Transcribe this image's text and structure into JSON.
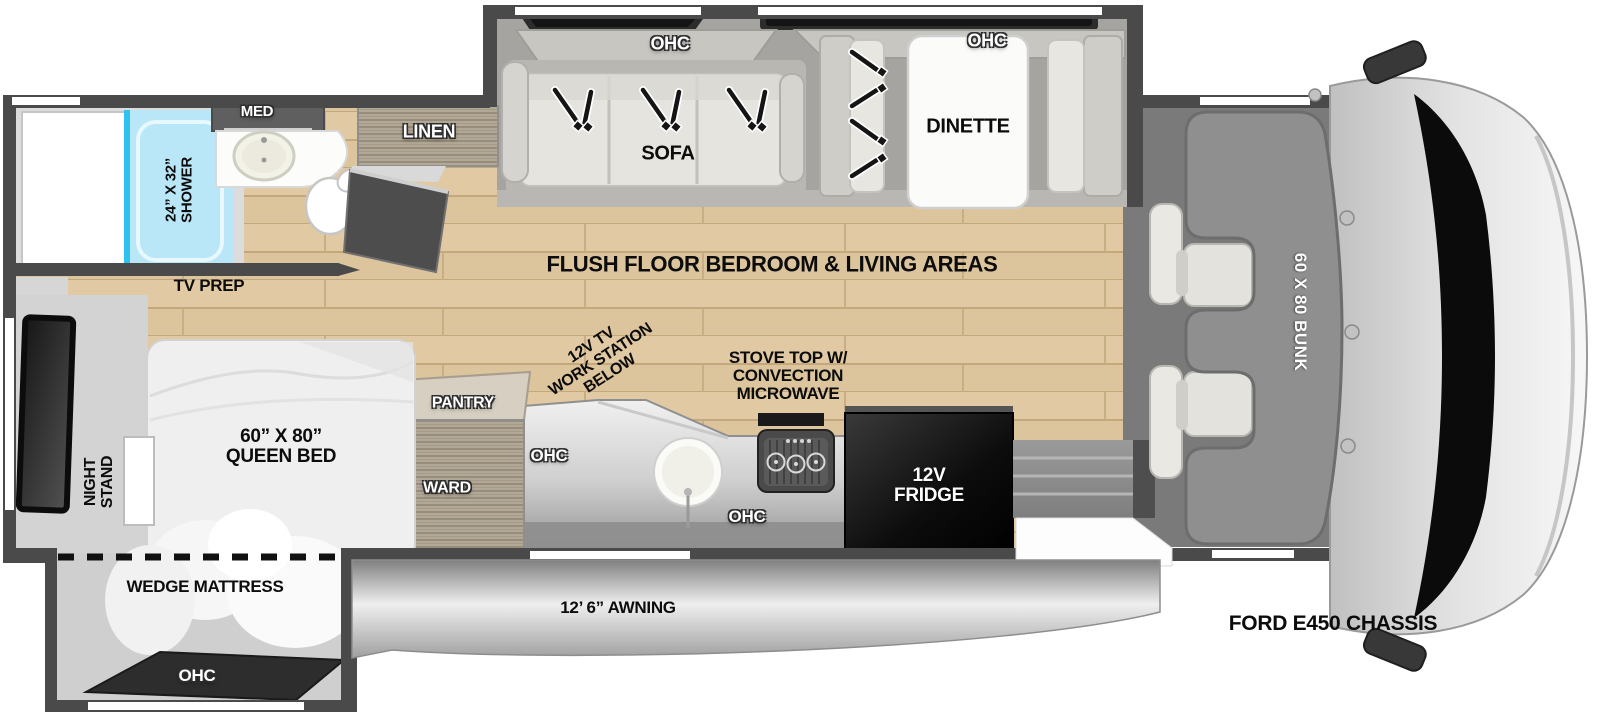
{
  "floorplan": {
    "living": {
      "ohc_sofa": "OHC",
      "sofa": "SOFA",
      "ohc_dinette": "OHC",
      "dinette": "DINETTE",
      "flush_floor": "FLUSH FLOOR BEDROOM & LIVING AREAS"
    },
    "bathroom": {
      "med": "MED",
      "shower": "24” X 32”\nSHOWER",
      "linen": "LINEN",
      "tv_prep": "TV PREP"
    },
    "kitchen": {
      "work_station": "12V TV\nWORK STATION\nBELOW",
      "stove": "STOVE TOP W/\nCONVECTION\nMICROWAVE",
      "ohc_upper": "OHC",
      "ohc_lower": "OHC",
      "fridge": "12V\nFRIDGE",
      "pantry": "PANTRY",
      "ward": "WARD"
    },
    "bedroom": {
      "night_stand": "NIGHT\nSTAND",
      "queen_bed": "60” X 80”\nQUEEN BED",
      "wedge_mattress": "WEDGE MATTRESS",
      "ohc": "OHC"
    },
    "cab": {
      "bunk": "60 X 80 BUNK",
      "chassis": "FORD E450 CHASSIS"
    },
    "exterior": {
      "awning": "12’ 6” AWNING"
    }
  },
  "colors": {
    "wall": "#4a4a4a",
    "wood_floor": "#dcc49c",
    "shower_fill": "#b9e7f7",
    "shower_accent": "#2fc2ec",
    "fridge": "#000000",
    "cushion": "#e6e4df",
    "bunk": "#8f8f8f",
    "awning_silver": "#d9d9d9",
    "windshield": "#0b0b0b"
  }
}
